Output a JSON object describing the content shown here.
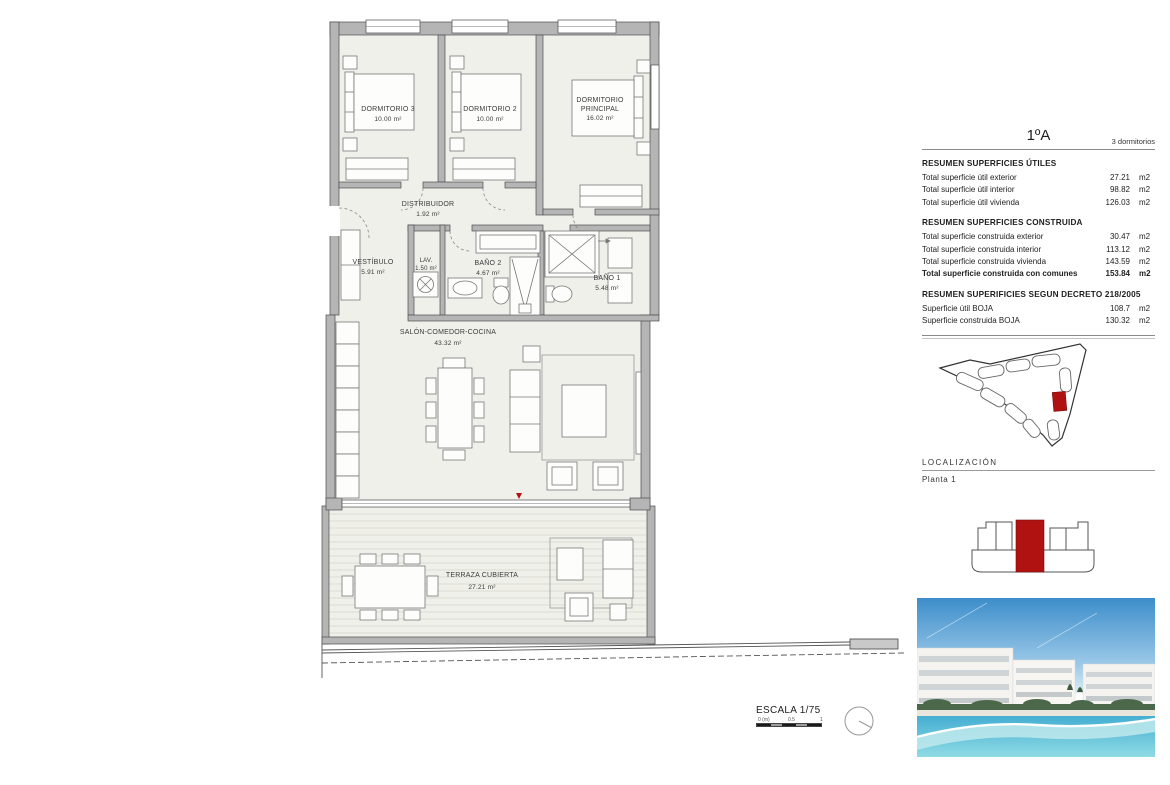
{
  "unit": {
    "name": "1ºA",
    "bedrooms": "3 dormitorios"
  },
  "sections": {
    "utiles": {
      "title": "RESUMEN SUPERFICIES ÚTILES",
      "rows": [
        {
          "label": "Total superficie útil exterior",
          "value": "27.21",
          "unit": "m2"
        },
        {
          "label": "Total superficie útil interior",
          "value": "98.82",
          "unit": "m2"
        },
        {
          "label": "Total superficie útil vivienda",
          "value": "126.03",
          "unit": "m2"
        }
      ]
    },
    "construida": {
      "title": "RESUMEN SUPERFICIES CONSTRUIDA",
      "rows": [
        {
          "label": "Total superficie construida exterior",
          "value": "30.47",
          "unit": "m2"
        },
        {
          "label": "Total superficie construida interior",
          "value": "113.12",
          "unit": "m2"
        },
        {
          "label": "Total superficie construida vivienda",
          "value": "143.59",
          "unit": "m2"
        },
        {
          "label": "Total superficie construida con comunes",
          "value": "153.84",
          "unit": "m2"
        }
      ]
    },
    "decreto": {
      "title": "RESUMEN SUPERIFICIES SEGUN DECRETO 218/2005",
      "rows": [
        {
          "label": "Superficie útil BOJA",
          "value": "108.7",
          "unit": "m2"
        },
        {
          "label": "Superficie construida BOJA",
          "value": "130.32",
          "unit": "m2"
        }
      ]
    }
  },
  "localizacion": {
    "title": "LOCALIZACIÓN",
    "planta": "Planta 1"
  },
  "plan": {
    "rooms": [
      {
        "name": "DORMITORIO 3",
        "area": "10.00 m²"
      },
      {
        "name": "DORMITORIO 2",
        "area": "10.00 m²"
      },
      {
        "name": "DORMITORIO",
        "name2": "PRINCIPAL",
        "area": "16.02 m²"
      },
      {
        "name": "DISTRIBUIDOR",
        "area": "1.92 m²"
      },
      {
        "name": "VESTÍBULO",
        "area": "5.91 m²"
      },
      {
        "name": "LAV.",
        "area": "1.50 m²"
      },
      {
        "name": "BAÑO 2",
        "area": "4.67 m²"
      },
      {
        "name": "BAÑO 1",
        "area": "5.48 m²"
      },
      {
        "name": "SALÓN-COMEDOR-COCINA",
        "area": "43.32 m²"
      },
      {
        "name": "TERRAZA CUBIERTA",
        "area": "27.21 m²"
      }
    ],
    "scale": {
      "label": "ESCALA 1/75",
      "t0": "0 (m)",
      "t05": "0.5",
      "t1": "1"
    }
  },
  "colors": {
    "accent_red": "#b01212",
    "wall_gray": "#b5b5b5",
    "floor": "#f0f0ea"
  }
}
